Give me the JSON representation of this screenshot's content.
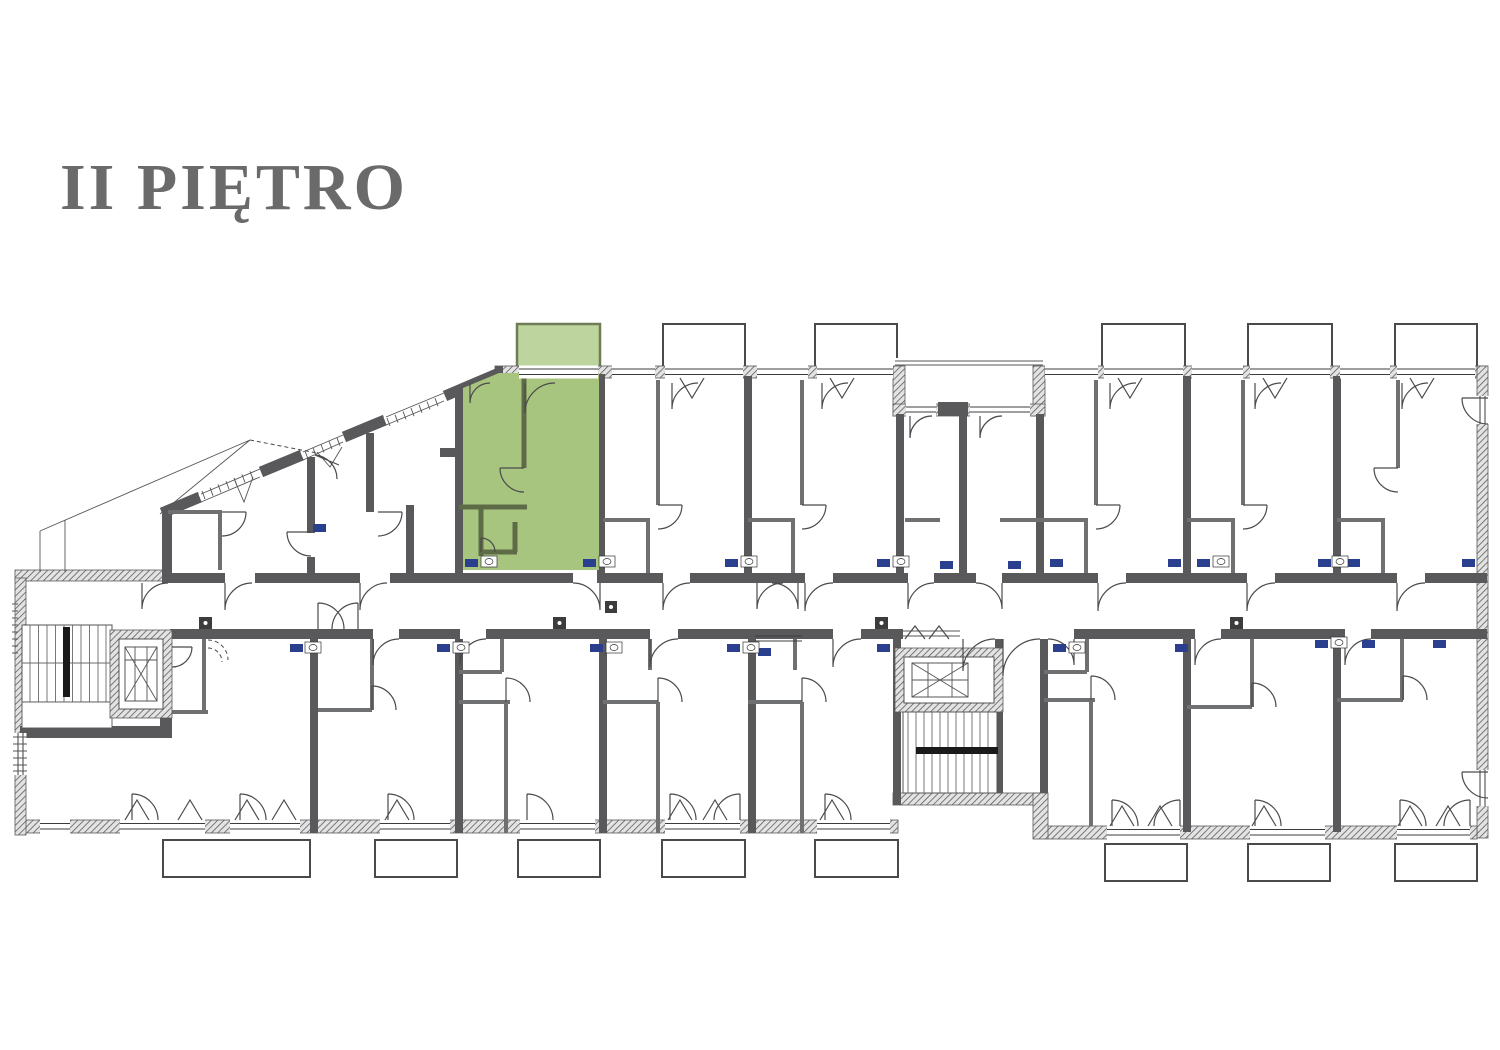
{
  "header": {
    "title": "II PIĘTRO"
  },
  "plan": {
    "name": "apartment-building-floor-plan",
    "floor_label": "II PIĘTRO",
    "highlighted_unit": {
      "fill": "#a8c57f",
      "wall_color": "#5e6b47",
      "balcony_fill": "#bdd49e",
      "balcony_border": "#6e7d55"
    },
    "colors": {
      "exterior_wall": "#59595b",
      "interior_wall": "#6f7072",
      "door_line": "#4a4a4a",
      "fixture_blue": "#2b3f8f",
      "title_text": "#6a6a6a",
      "background": "#ffffff"
    }
  }
}
